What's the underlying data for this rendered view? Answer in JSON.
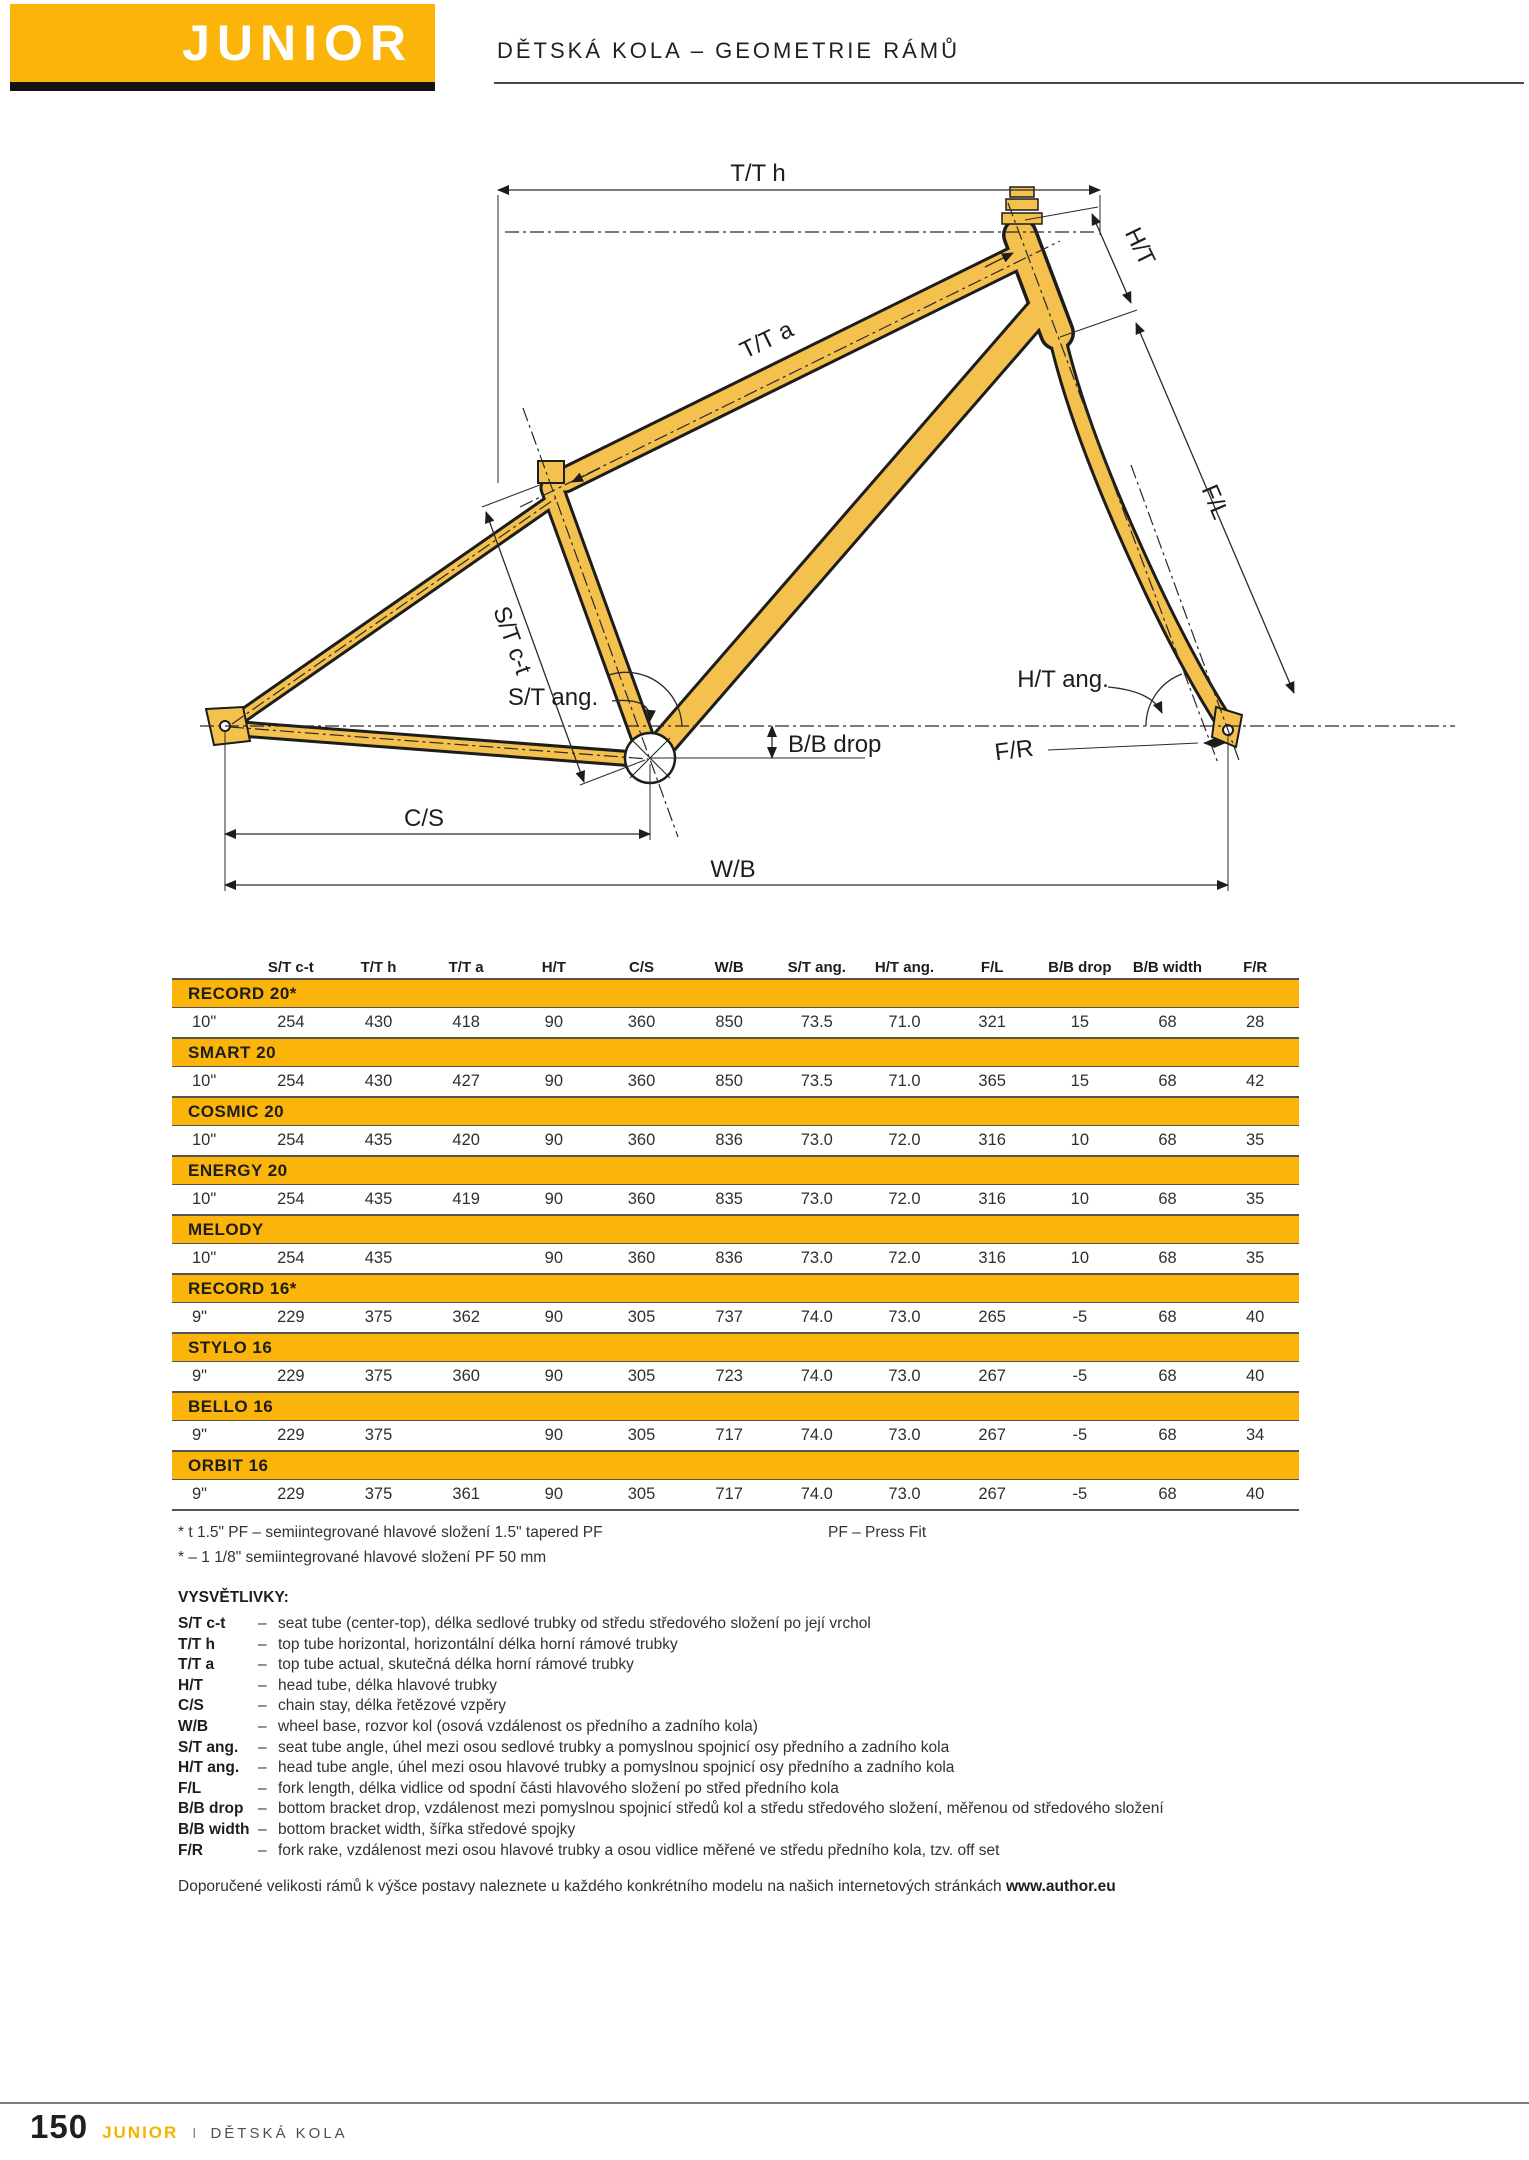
{
  "header": {
    "brand": "JUNIOR",
    "subtitle": "DĚTSKÁ KOLA – GEOMETRIE RÁMŮ"
  },
  "diagram": {
    "labels": {
      "tth": "T/T h",
      "tta": "T/T a",
      "ht": "H/T",
      "fl": "F/L",
      "stct": "S/T c-t",
      "stang": "S/T ang.",
      "htang": "H/T ang.",
      "bbdrop": "B/B drop",
      "fr": "F/R",
      "cs": "C/S",
      "wb": "W/B"
    }
  },
  "table": {
    "columns": [
      "S/T c-t",
      "T/T h",
      "T/T a",
      "H/T",
      "C/S",
      "W/B",
      "S/T ang.",
      "H/T ang.",
      "F/L",
      "B/B drop",
      "B/B width",
      "F/R"
    ],
    "models": [
      {
        "name": "RECORD 20*",
        "size": "10\"",
        "values": [
          "254",
          "430",
          "418",
          "90",
          "360",
          "850",
          "73.5",
          "71.0",
          "321",
          "15",
          "68",
          "28"
        ]
      },
      {
        "name": "SMART 20",
        "size": "10\"",
        "values": [
          "254",
          "430",
          "427",
          "90",
          "360",
          "850",
          "73.5",
          "71.0",
          "365",
          "15",
          "68",
          "42"
        ]
      },
      {
        "name": "COSMIC 20",
        "size": "10\"",
        "values": [
          "254",
          "435",
          "420",
          "90",
          "360",
          "836",
          "73.0",
          "72.0",
          "316",
          "10",
          "68",
          "35"
        ]
      },
      {
        "name": "ENERGY 20",
        "size": "10\"",
        "values": [
          "254",
          "435",
          "419",
          "90",
          "360",
          "835",
          "73.0",
          "72.0",
          "316",
          "10",
          "68",
          "35"
        ]
      },
      {
        "name": "MELODY",
        "size": "10\"",
        "values": [
          "254",
          "435",
          "",
          "90",
          "360",
          "836",
          "73.0",
          "72.0",
          "316",
          "10",
          "68",
          "35"
        ]
      },
      {
        "name": "RECORD 16*",
        "size": "9\"",
        "values": [
          "229",
          "375",
          "362",
          "90",
          "305",
          "737",
          "74.0",
          "73.0",
          "265",
          "-5",
          "68",
          "40"
        ]
      },
      {
        "name": "STYLO 16",
        "size": "9\"",
        "values": [
          "229",
          "375",
          "360",
          "90",
          "305",
          "723",
          "74.0",
          "73.0",
          "267",
          "-5",
          "68",
          "40"
        ]
      },
      {
        "name": "BELLO 16",
        "size": "9\"",
        "values": [
          "229",
          "375",
          "",
          "90",
          "305",
          "717",
          "74.0",
          "73.0",
          "267",
          "-5",
          "68",
          "34"
        ]
      },
      {
        "name": "ORBIT 16",
        "size": "9\"",
        "values": [
          "229",
          "375",
          "361",
          "90",
          "305",
          "717",
          "74.0",
          "73.0",
          "267",
          "-5",
          "68",
          "40"
        ]
      }
    ]
  },
  "footnotes": {
    "line1": "* t 1.5\" PF – semiintegrované hlavové složení 1.5\" tapered PF",
    "line1_right": "PF – Press Fit",
    "line2": "* – 1 1/8\" semiintegrované hlavové složení PF 50 mm"
  },
  "legend": {
    "title": "VYSVĚTLIVKY:",
    "separator": "–",
    "items": [
      {
        "term": "S/T c-t",
        "desc": "seat tube (center-top), délka sedlové trubky od středu středového složení po její vrchol"
      },
      {
        "term": "T/T h",
        "desc": "top tube horizontal, horizontální délka horní rámové trubky"
      },
      {
        "term": "T/T a",
        "desc": "top tube actual, skutečná délka horní rámové trubky"
      },
      {
        "term": "H/T",
        "desc": "head tube, délka hlavové trubky"
      },
      {
        "term": "C/S",
        "desc": "chain stay, délka řetězové vzpěry"
      },
      {
        "term": "W/B",
        "desc": "wheel base, rozvor kol (osová vzdálenost os předního a zadního kola)"
      },
      {
        "term": "S/T ang.",
        "desc": "seat tube angle, úhel mezi osou sedlové trubky a pomyslnou spojnicí osy předního a zadního kola"
      },
      {
        "term": "H/T ang.",
        "desc": "head tube angle, úhel mezi osou hlavové trubky a pomyslnou spojnicí osy předního a zadního kola"
      },
      {
        "term": "F/L",
        "desc": "fork length, délka vidlice od spodní části hlavového složení po střed předního kola"
      },
      {
        "term": "B/B drop",
        "desc": "bottom bracket drop, vzdálenost mezi pomyslnou spojnicí středů kol a středu středového složení, měřenou od středového složení"
      },
      {
        "term": "B/B width",
        "desc": "bottom bracket width, šířka středové spojky"
      },
      {
        "term": "F/R",
        "desc": "fork rake, vzdálenost mezi osou hlavové trubky a osou vidlice měřené ve středu předního kola, tzv. off set"
      }
    ]
  },
  "note": {
    "text": "Doporučené velikosti rámů k výšce postavy naleznete u každého konkrétního modelu na našich internetových stránkách",
    "link": "www.author.eu"
  },
  "footer": {
    "page": "150",
    "brand": "JUNIOR",
    "separator": "I",
    "section": "DĚTSKÁ KOLA"
  },
  "colors": {
    "accent": "#FBB409",
    "frame_fill": "#F4C14F",
    "text": "#1D1D1B"
  }
}
